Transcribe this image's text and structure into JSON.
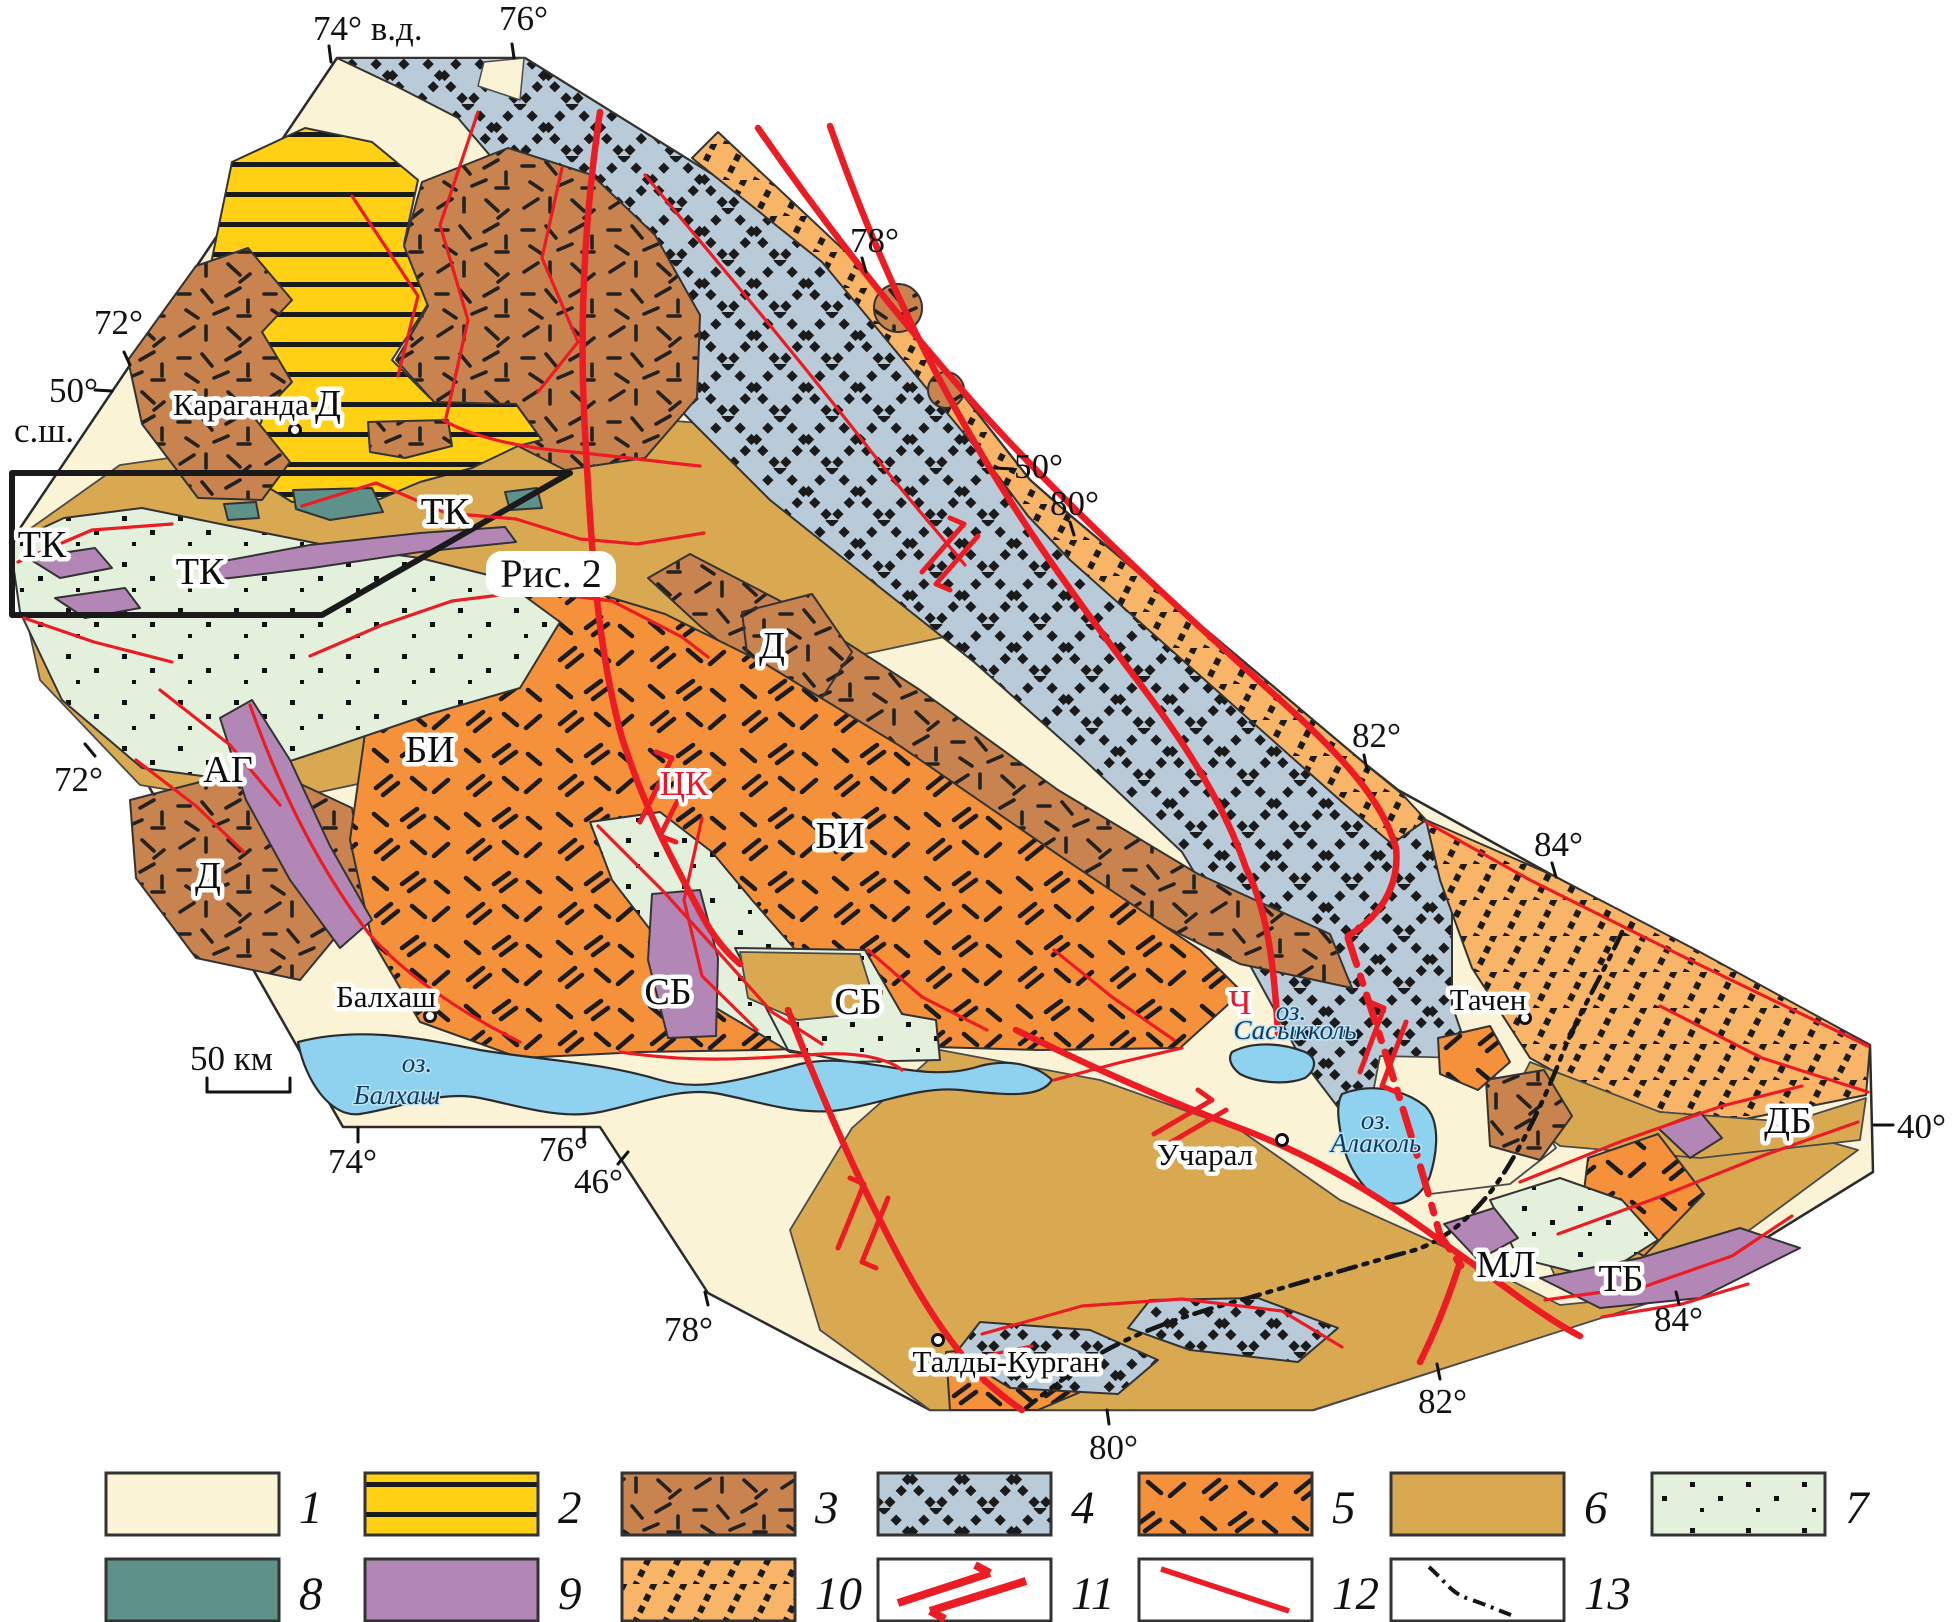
{
  "colors": {
    "cream": "#FBF3D6",
    "yellow": "#FFD014",
    "brown": "#C9834E",
    "blue_gray": "#B9CBD9",
    "orange": "#F5913B",
    "tan": "#D9A952",
    "mint": "#E3F0DC",
    "teal": "#5E9189",
    "purple": "#B287B5",
    "stripe_orange": "#F9B567",
    "lake_blue": "#8FD2F0",
    "fault_red": "#EC1C24",
    "line_black": "#1c1c1c"
  },
  "map": {
    "inset_box_label": "Рис. 2",
    "scale_bar": {
      "label": "50 км"
    },
    "coordinate_labels": [
      {
        "text": "74° в.д.",
        "x": 313,
        "y": 40
      },
      {
        "text": "76°",
        "x": 499,
        "y": 30
      },
      {
        "text": "78°",
        "x": 850,
        "y": 252
      },
      {
        "text": "50°",
        "x": 1014,
        "y": 478
      },
      {
        "text": "80°",
        "x": 1050,
        "y": 515
      },
      {
        "text": "82°",
        "x": 1352,
        "y": 747
      },
      {
        "text": "84°",
        "x": 1534,
        "y": 856
      },
      {
        "text": "40°",
        "x": 1897,
        "y": 1138
      },
      {
        "text": "84°",
        "x": 1654,
        "y": 1331
      },
      {
        "text": "82°",
        "x": 1418,
        "y": 1413
      },
      {
        "text": "80°",
        "x": 1089,
        "y": 1459
      },
      {
        "text": "78°",
        "x": 664,
        "y": 1341
      },
      {
        "text": "76°",
        "x": 539,
        "y": 1161
      },
      {
        "text": "46°",
        "x": 574,
        "y": 1193
      },
      {
        "text": "74°",
        "x": 328,
        "y": 1173
      },
      {
        "text": "72°",
        "x": 94,
        "y": 334
      },
      {
        "text": "50°",
        "x": 49,
        "y": 402
      },
      {
        "text": "с.ш.",
        "x": 14,
        "y": 442
      },
      {
        "text": "72°",
        "x": 54,
        "y": 791
      }
    ],
    "cities": [
      {
        "name": "Караганда",
        "x": 241,
        "y": 415,
        "dot_x": 295,
        "dot_y": 430
      },
      {
        "name": "Балхаш",
        "x": 386,
        "y": 1007,
        "dot_x": 430,
        "dot_y": 1016
      },
      {
        "name": "Учарал",
        "x": 1205,
        "y": 1165,
        "dot_x": 1282,
        "dot_y": 1140
      },
      {
        "name": "Талды-Курган",
        "x": 1006,
        "y": 1372,
        "dot_x": 938,
        "dot_y": 1340
      },
      {
        "name": "Тачен",
        "x": 1488,
        "y": 1010,
        "dot_x": 1525,
        "dot_y": 1018
      }
    ],
    "lake_labels": [
      {
        "text": "оз.",
        "x": 417,
        "y": 1072
      },
      {
        "text": "Балхаш",
        "x": 397,
        "y": 1104
      },
      {
        "text": "оз.",
        "x": 1291,
        "y": 1020
      },
      {
        "text": "Сасыкколь",
        "x": 1295,
        "y": 1039
      },
      {
        "text": "оз.",
        "x": 1376,
        "y": 1129
      },
      {
        "text": "Алаколь",
        "x": 1376,
        "y": 1152
      }
    ],
    "region_labels": [
      {
        "text": "Д",
        "x": 328,
        "y": 416
      },
      {
        "text": "Д",
        "x": 772,
        "y": 658
      },
      {
        "text": "Д",
        "x": 208,
        "y": 888
      },
      {
        "text": "ТК",
        "x": 42,
        "y": 557
      },
      {
        "text": "ТК",
        "x": 200,
        "y": 584
      },
      {
        "text": "ТК",
        "x": 445,
        "y": 524
      },
      {
        "text": "АГ",
        "x": 228,
        "y": 782
      },
      {
        "text": "БИ",
        "x": 430,
        "y": 762
      },
      {
        "text": "БИ",
        "x": 840,
        "y": 848
      },
      {
        "text": "СБ",
        "x": 668,
        "y": 1004
      },
      {
        "text": "СБ",
        "x": 858,
        "y": 1014
      },
      {
        "text": "МЛ",
        "x": 1506,
        "y": 1277
      },
      {
        "text": "ТБ",
        "x": 1621,
        "y": 1291
      },
      {
        "text": "ДБ",
        "x": 1788,
        "y": 1133
      }
    ],
    "fault_labels": [
      {
        "text": "ЦК",
        "x": 684,
        "y": 795
      },
      {
        "text": "Ч",
        "x": 1240,
        "y": 1014
      }
    ]
  },
  "legend": {
    "items": [
      {
        "number": "1",
        "swatch": "cream"
      },
      {
        "number": "2",
        "swatch": "yellow-lines"
      },
      {
        "number": "3",
        "swatch": "brown-hachure"
      },
      {
        "number": "4",
        "swatch": "blue-check"
      },
      {
        "number": "5",
        "swatch": "orange-hachure"
      },
      {
        "number": "6",
        "swatch": "tan"
      },
      {
        "number": "7",
        "swatch": "mint-dots"
      },
      {
        "number": "8",
        "swatch": "teal"
      },
      {
        "number": "9",
        "swatch": "purple"
      },
      {
        "number": "10",
        "swatch": "orange-stripes"
      },
      {
        "number": "11",
        "swatch": "strike-slip"
      },
      {
        "number": "12",
        "swatch": "fault-line"
      },
      {
        "number": "13",
        "swatch": "boundary-line"
      }
    ]
  }
}
